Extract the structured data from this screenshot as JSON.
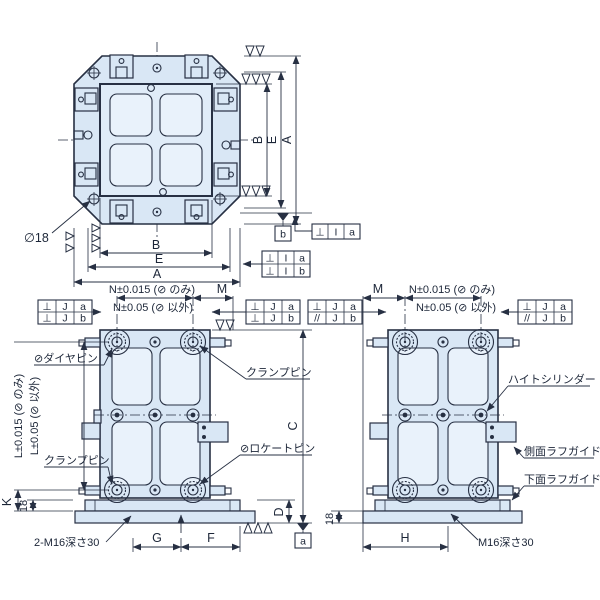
{
  "top_view": {
    "dim_b_h": "B",
    "dim_e_h": "E",
    "dim_a_h": "A",
    "dim_b_v": "B",
    "dim_e_v": "E",
    "dim_a_v": "A",
    "phi18": "∅18",
    "datum_b": "b",
    "fcf_single": [
      "⊥",
      "I",
      "a"
    ],
    "fcf_stacked": {
      "rows": [
        [
          "⊥",
          "I",
          "a"
        ],
        [
          "⊥",
          "I",
          "b"
        ]
      ]
    }
  },
  "front_view": {
    "dim_n1": "N±0.015 (⊘ のみ)",
    "dim_n2": "N±0.05 (⊘ 以外)",
    "dim_m": "M",
    "dim_l1": "L±0.015 (⊘ のみ)",
    "dim_l2": "L±0.05 (⊘ 以外)",
    "dim_k": "K",
    "dim_18": "18",
    "dim_g": "G",
    "dim_f": "F",
    "dim_c": "C",
    "dim_d": "D",
    "datum_a": "a",
    "label_dia_pin": "⊘ダイヤピン",
    "label_clamp_pin_top": "クランプピン",
    "label_clamp_pin_bottom": "クランプピン",
    "label_locate_pin": "⊘ロケートピン",
    "label_tap": "2-M16深さ30",
    "fcf_left": {
      "rows": [
        [
          "⊥",
          "J",
          "a"
        ],
        [
          "⊥",
          "J",
          "b"
        ]
      ]
    },
    "fcf_right": {
      "rows": [
        [
          "⊥",
          "J",
          "a"
        ],
        [
          "⊥",
          "J",
          "b"
        ]
      ]
    }
  },
  "side_view": {
    "dim_m": "M",
    "dim_n1": "N±0.015 (⊘ のみ)",
    "dim_n2": "N±0.05 (⊘ 以外)",
    "dim_18": "18",
    "dim_h": "H",
    "label_height_cylinder": "ハイトシリンダー",
    "label_side_guide": "側面ラフガイド",
    "label_bottom_guide": "下面ラフガイド",
    "label_tap": "M16深さ30",
    "fcf_left": {
      "rows": [
        [
          "⊥",
          "J",
          "a"
        ],
        [
          "//",
          "J",
          "b"
        ]
      ]
    },
    "fcf_right": {
      "rows": [
        [
          "⊥",
          "J",
          "a"
        ],
        [
          "//",
          "J",
          "b"
        ]
      ]
    }
  },
  "colors": {
    "plate_fill": "#d9e7f5",
    "line": "#273043"
  }
}
